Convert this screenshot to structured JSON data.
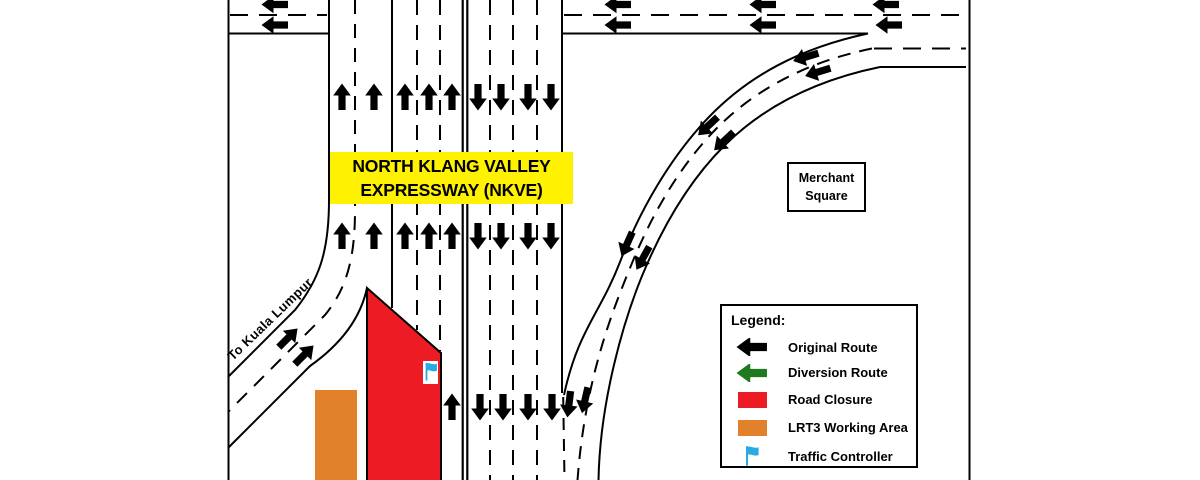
{
  "diagram": {
    "title_line1": "NORTH KLANG VALLEY",
    "title_line2": "EXPRESSWAY (NKVE)",
    "ramp_label": "To Kuala Lumpur",
    "place_label_line1": "Merchant",
    "place_label_line2": "Square"
  },
  "legend": {
    "title": "Legend:",
    "items": [
      {
        "icon": "black-left-arrow",
        "label": "Original Route",
        "color": "#000000"
      },
      {
        "icon": "green-left-arrow",
        "label": "Diversion Route",
        "color": "#1F7A1F"
      },
      {
        "icon": "red-swatch",
        "label": "Road Closure",
        "color": "#ED1C24"
      },
      {
        "icon": "orange-swatch",
        "label": "LRT3 Working Area",
        "color": "#E1812C"
      },
      {
        "icon": "blue-flag",
        "label": "Traffic Controller",
        "color": "#29ABE2"
      }
    ]
  },
  "colors": {
    "closure_red": "#ED1C24",
    "working_area_orange": "#E1812C",
    "flag_blue": "#29ABE2",
    "highlight_yellow": "#FFF200",
    "line_black": "#000000"
  }
}
